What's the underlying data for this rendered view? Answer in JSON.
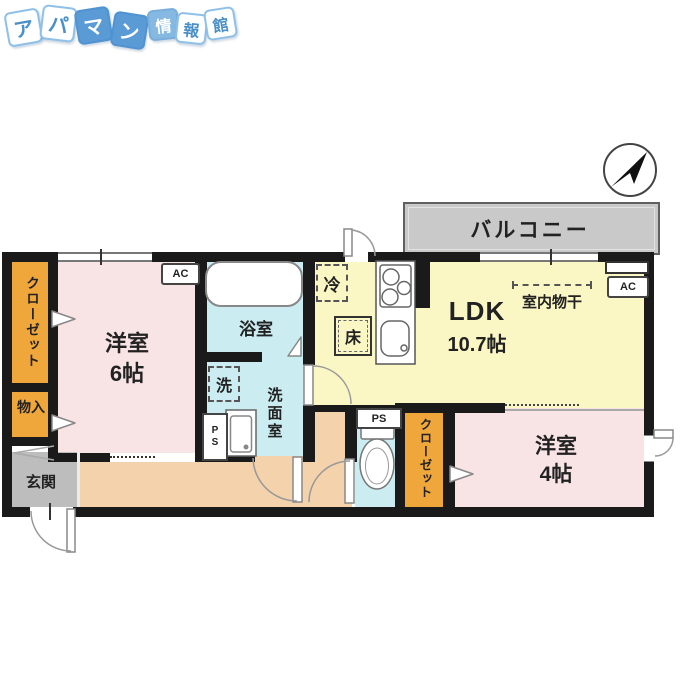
{
  "logo": {
    "name": "アパマン情報館",
    "tiles": [
      "ア",
      "パ",
      "マ",
      "ン",
      "情",
      "報",
      "館"
    ]
  },
  "compass": {
    "icon": "north-arrow-icon"
  },
  "balcony": {
    "label": "バルコニー"
  },
  "ldk": {
    "label": "LDK",
    "size": "10.7帖",
    "ac_label": "AC",
    "fridge_label": "冷",
    "floor_hatch_label": "床",
    "indoor_drying_label": "室内物干"
  },
  "room6": {
    "label": "洋室",
    "size": "6帖",
    "ac_label": "AC"
  },
  "room4": {
    "label": "洋室",
    "size": "4帖"
  },
  "bath": {
    "label": "浴室"
  },
  "washroom": {
    "label": "洗面室",
    "washer_label": "洗",
    "ps_label": "PS"
  },
  "toilet": {
    "ps_label": "PS"
  },
  "closet_left": {
    "label": "クローゼット"
  },
  "closet_right": {
    "label": "クローゼット"
  },
  "storage": {
    "label": "物入"
  },
  "entrance": {
    "label": "玄関"
  },
  "colors": {
    "room_pink": "#F8E3E5",
    "ldk_yellow": "#FBF7C5",
    "wet_blue": "#CBEDF2",
    "closet_orange": "#EFA63B",
    "hall_peach": "#F4D2AB",
    "entrance_gray": "#BDBDBD",
    "balcony_gray": "#C9C9C9",
    "wall_black": "#1A1A1A",
    "logo_blue": "#5B9BD5"
  }
}
